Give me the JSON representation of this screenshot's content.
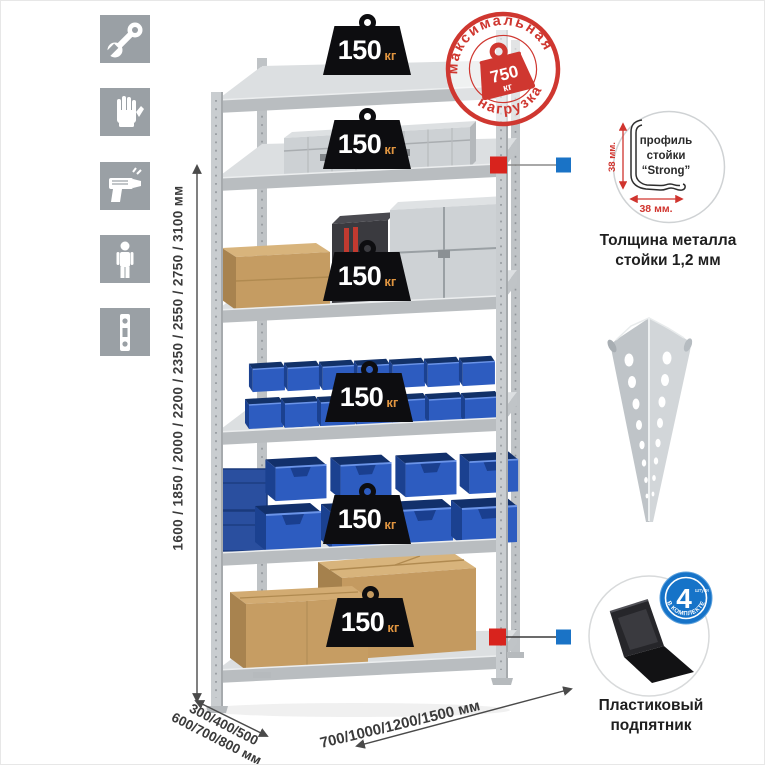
{
  "page": {
    "background": "#ffffff"
  },
  "toolbar_icons": [
    {
      "name": "wrench-icon"
    },
    {
      "name": "gloves-icon"
    },
    {
      "name": "drill-icon"
    },
    {
      "name": "person-icon"
    },
    {
      "name": "level-icon"
    }
  ],
  "rack": {
    "shelf_count": 6,
    "badges": [
      {
        "value": "150",
        "unit": "кг"
      },
      {
        "value": "150",
        "unit": "кг"
      },
      {
        "value": "150",
        "unit": "кг"
      },
      {
        "value": "150",
        "unit": "кг"
      },
      {
        "value": "150",
        "unit": "кг"
      },
      {
        "value": "150",
        "unit": "кг"
      }
    ],
    "stamp": {
      "arc_top": "максимальная",
      "arc_bottom": "нагрузка",
      "weight_value": "750",
      "weight_unit": "кг",
      "color": "#cf3730"
    },
    "dims": {
      "height": "1600 / 1850 / 2000 / 2200 / 2350 / 2550 / 2750 / 3100 мм",
      "depth_line1": "300/400/500",
      "depth_line2": "600/700/800 мм",
      "width": "700/1000/1200/1500 мм"
    }
  },
  "details": {
    "profile": {
      "label1": "профиль",
      "label2": "стойки",
      "label3": "“Strong”",
      "dim_vertical": "38 мм.",
      "dim_horizontal": "38 мм.",
      "caption1": "Толщина металла",
      "caption2": "стойки 1,2 мм"
    },
    "foot": {
      "caption1": "Пластиковый",
      "caption2": "подпятник",
      "badge_value": "4",
      "badge_small": "штуки",
      "badge_ring": "в комплекте"
    }
  },
  "colors": {
    "accent_red": "#cf3730",
    "accent_blue": "#1a73c6",
    "bin_blue": "#2d5cc0",
    "steel": "#c9cdd0",
    "cardboard": "#c49a60",
    "tile_gray": "#9aa0a5"
  }
}
